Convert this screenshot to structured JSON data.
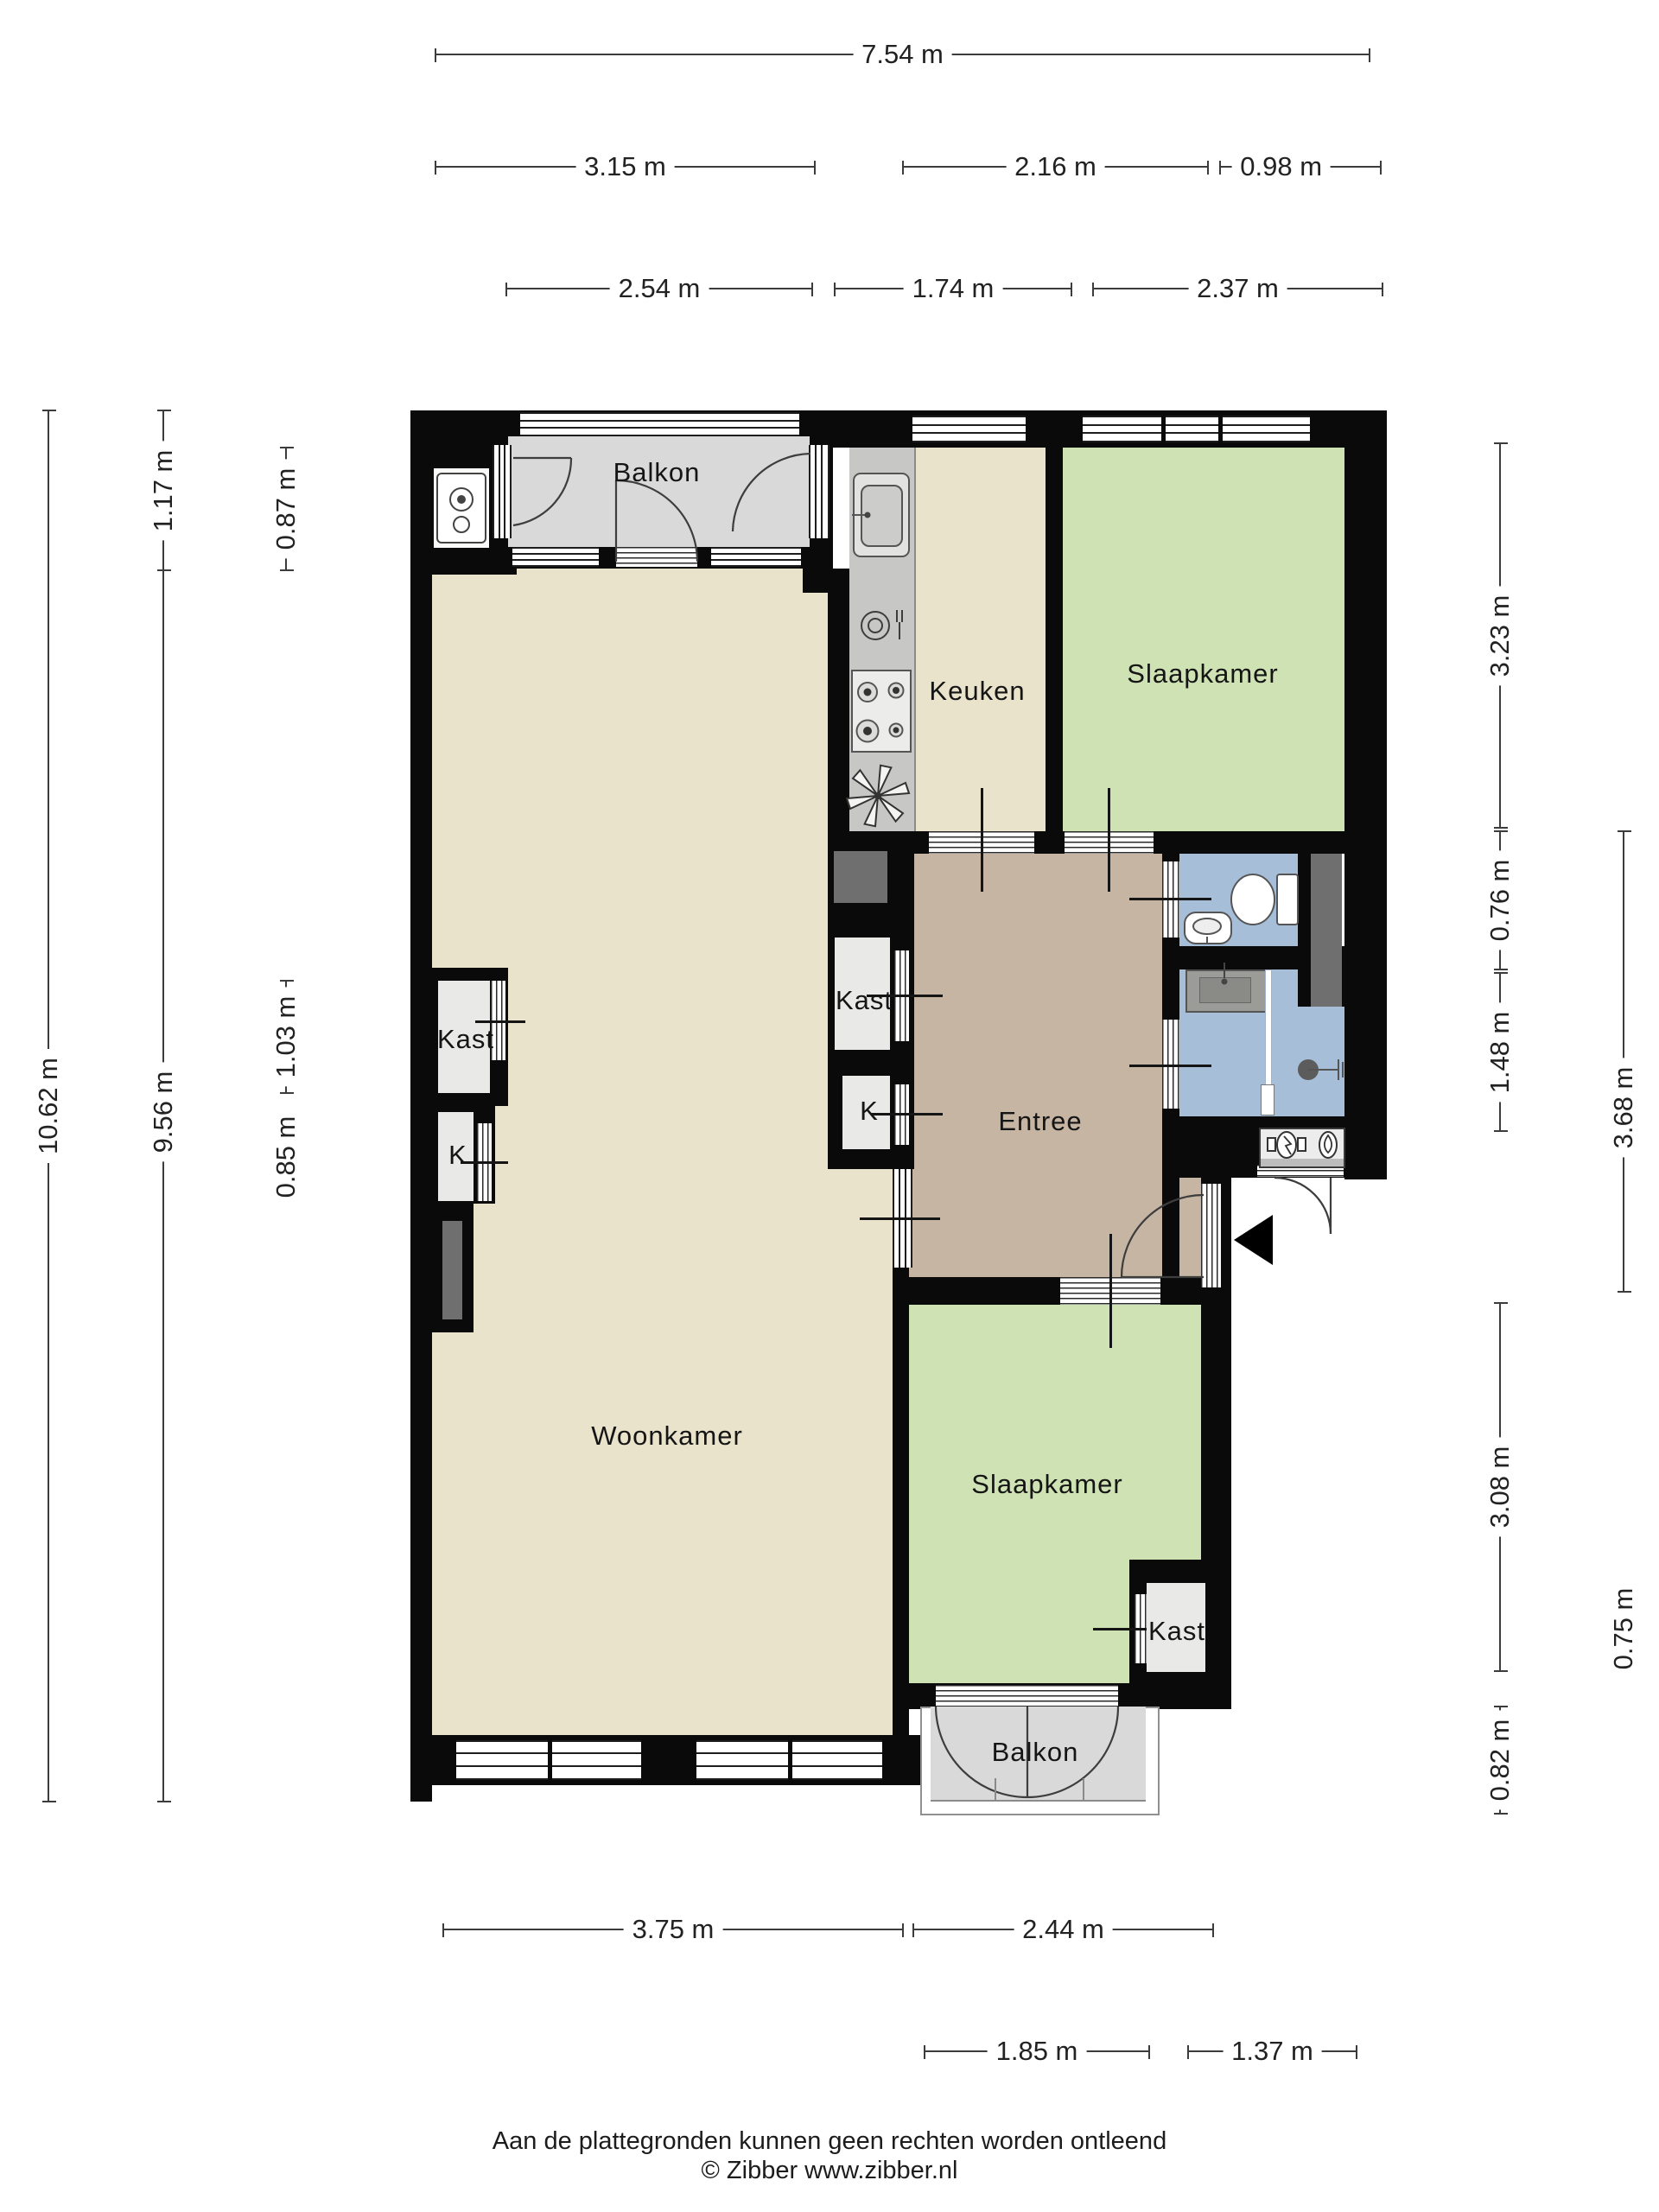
{
  "rooms": {
    "balkon_top": "Balkon",
    "keuken": "Keuken",
    "slaapkamer_top": "Slaapkamer",
    "kast_mid": "Kast",
    "k_mid": "K",
    "entree": "Entree",
    "kast_left": "Kast",
    "k_left": "K",
    "woonkamer": "Woonkamer",
    "slaapkamer_bottom": "Slaapkamer",
    "kast_bottom": "Kast",
    "balkon_bottom": "Balkon"
  },
  "dims": {
    "top1": [
      "7.54 m"
    ],
    "top2": [
      "3.15 m",
      "2.16 m",
      "0.98 m"
    ],
    "top3": [
      "2.54 m",
      "1.74 m",
      "2.37 m"
    ],
    "left": [
      "10.62 m",
      "1.17 m",
      "9.56 m",
      "0.87 m",
      "1.03 m",
      "0.85 m"
    ],
    "right": [
      "3.23 m",
      "0.76 m",
      "1.48 m",
      "3.08 m",
      "0.82 m",
      "3.68 m",
      "0.75 m"
    ],
    "bottom1": [
      "3.75 m",
      "2.44 m"
    ],
    "bottom2": [
      "1.85 m",
      "1.37 m"
    ]
  },
  "footer": {
    "disclaimer": "Aan de plattegronden kunnen geen rechten worden ontleend",
    "copyright": "© Zibber www.zibber.nl"
  },
  "colors": {
    "wall": "#0a0a0a",
    "living_floor": "#eae3cb",
    "bedroom_floor": "#cfe2b4",
    "hall_floor": "#c6b5a2",
    "bath_floor": "#a7bed9",
    "balcony_floor": "#d9d9d9",
    "closet_floor": "#e9e9e7",
    "counter": "#c7c7c5",
    "shaft": "#6f6f6f"
  },
  "icons": [
    "boiler-icon",
    "sink-icon",
    "dishwasher-icon",
    "stove-icon",
    "extractor-icon",
    "toilet-icon",
    "hand-basin-icon",
    "washbasin-icon",
    "shower-icon",
    "electric-meter-icon",
    "gas-meter-icon",
    "entrance-arrow-icon"
  ]
}
